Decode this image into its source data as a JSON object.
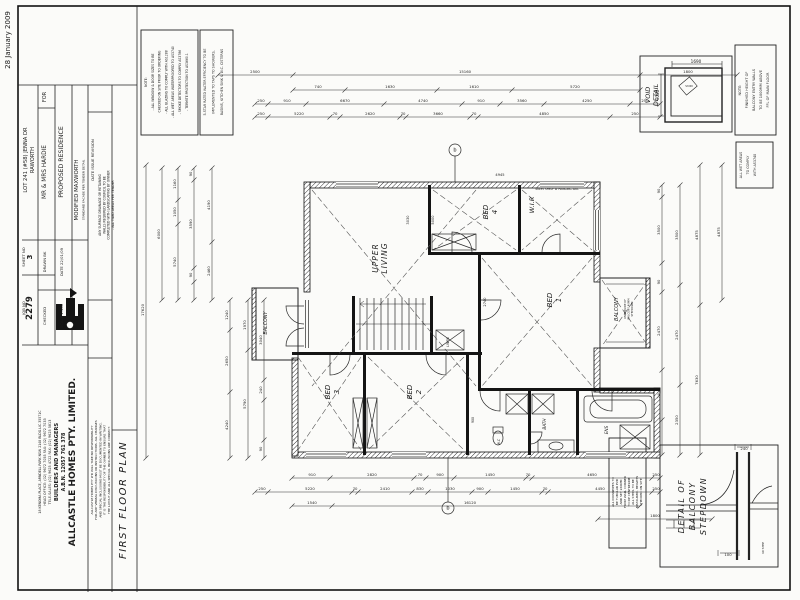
{
  "title_block": {
    "plan_title": "FIRST FLOOR PLAN",
    "side_date": "28 January 2009",
    "client_for": "FOR",
    "client": "MR & MRS HARDIE",
    "project": "PROPOSED RESIDENCE",
    "lot_line1": "LOT 241 (#58) JENNA DR",
    "lot_line2": "RAWORTH",
    "model": "MODIFIED MAXWORTH",
    "model_sub": "STANDARD FACADE PER TENDER DETAIL",
    "date": "DATE 22/01/09",
    "scale": "SCALE 1:100",
    "drawn": "DRAWN BK",
    "checked": "CHECKED",
    "sheet_label": "SHEET NO",
    "sheet_no": "3",
    "job_label": "JOB NO",
    "job_no": "2279",
    "revision_header": "DATE        ISSUE        REVISION",
    "company": {
      "name": "ALLCASTLE HOMES PTY. LIMITED.",
      "abn": "A.B.N. 12057 761 378",
      "role": "BUILDERS AND MANAGERS",
      "tel": "TELE-SALES: (02) 9625 4722   FAX: (02) 9625 5813",
      "head": "HEAD OFFICE: (02) 9672 7055   FAX: (02) 9672 7033",
      "address": "18 KENOMA PLACE, ARNDELL PARK NSW 2148    BLDG.LIC.35571C"
    }
  },
  "texts": [
    {
      "n": "side-date",
      "t": "28 January 2009",
      "x": 10,
      "y": 40,
      "rot": 1,
      "s": 7
    },
    {
      "n": "lot-block",
      "lines": [
        "LOT 241 (#58) JENNA DR",
        "RAWORTH"
      ],
      "x": 27,
      "y": 160,
      "rot": 1,
      "s": 5.2,
      "lh": 7
    },
    {
      "n": "sheet-label",
      "t": "SHEET NO",
      "x": 25,
      "y": 257,
      "rot": 1,
      "s": 3.8
    },
    {
      "n": "sheet-no",
      "t": "3",
      "x": 32,
      "y": 257,
      "rot": 1,
      "s": 7,
      "b": 1
    },
    {
      "n": "job-label",
      "t": "JOB NO",
      "x": 25,
      "y": 308,
      "rot": 1,
      "s": 3.8
    },
    {
      "n": "job-no",
      "t": "2279",
      "x": 32,
      "y": 308,
      "rot": 1,
      "s": 8.5,
      "b": 1
    },
    {
      "n": "for-label",
      "t": "FOR",
      "x": 46,
      "y": 97,
      "rot": 1,
      "s": 5
    },
    {
      "n": "client",
      "t": "MR & MRS HARDIE",
      "x": 46,
      "y": 172,
      "rot": 1,
      "s": 5.8
    },
    {
      "n": "drawn",
      "t": "DRAWN BK",
      "x": 46,
      "y": 262,
      "rot": 1,
      "s": 3.8
    },
    {
      "n": "checked",
      "t": "CHECKED",
      "x": 46,
      "y": 316,
      "rot": 1,
      "s": 3.8
    },
    {
      "n": "project",
      "t": "PROPOSED RESIDENCE",
      "x": 63,
      "y": 162,
      "rot": 1,
      "s": 6.2
    },
    {
      "n": "date",
      "t": "DATE 22/01/09",
      "x": 63,
      "y": 262,
      "rot": 1,
      "s": 3.8
    },
    {
      "n": "scale",
      "t": "SCALE 1:100",
      "x": 63,
      "y": 316,
      "rot": 1,
      "s": 3.8
    },
    {
      "n": "model",
      "t": "MODIFIED MAXWORTH",
      "x": 78,
      "y": 190,
      "rot": 1,
      "s": 5.4
    },
    {
      "n": "model-sub",
      "t": "STANDARD FACADE PER TENDER DETAIL",
      "x": 84.5,
      "y": 190,
      "rot": 1,
      "s": 3
    },
    {
      "n": "revision-header",
      "t": "DATE        ISSUE        REVISION",
      "x": 94,
      "y": 160,
      "rot": 1,
      "s": 3.8
    },
    {
      "n": "drainage-note",
      "lines": [
        "ANY SURFACE DRAINAGE OR RETAINING",
        "WALLS REQUIRED BY COUNCIL TO BE",
        "COMPLETED WITH LANDSCAPING BY OWNER",
        "- ALL TILED AREAS PER TENDER"
      ],
      "x": 101,
      "y": 205,
      "rot": 1,
      "s": 3.1,
      "lh": 4.3
    },
    {
      "n": "company-name",
      "t": "ALLCASTLE HOMES PTY. LIMITED.",
      "x": 75,
      "y": 462,
      "rot": 1,
      "s": 9,
      "b": 1
    },
    {
      "n": "company-abn",
      "t": "A.B.N. 12057 761 378",
      "x": 65,
      "y": 462,
      "rot": 1,
      "s": 4.8,
      "b": 1
    },
    {
      "n": "company-role",
      "t": "BUILDERS AND MANAGERS",
      "x": 58,
      "y": 462,
      "rot": 1,
      "s": 5.2,
      "b": 1
    },
    {
      "n": "company-tel",
      "t": "TELE-SALES: (02) 9625 4722   FAX: (02) 9625 5813",
      "x": 51,
      "y": 462,
      "rot": 1,
      "s": 3.4
    },
    {
      "n": "company-head",
      "t": "HEAD OFFICE: (02) 9672 7055   FAX: (02) 9672 7033",
      "x": 46,
      "y": 462,
      "rot": 1,
      "s": 3.4
    },
    {
      "n": "company-address",
      "t": "18 KENOMA PLACE, ARNDELL PARK NSW 2148    BLDG.LIC.35571C",
      "x": 41,
      "y": 462,
      "rot": 1,
      "s": 3.2
    },
    {
      "n": "disclaimer",
      "lines": [
        "ALLCASTLE HOMES PTY LTD WILL TAKE NO RESPONSIBILITY",
        "FOR ANY VERBAL DISCUSSIONS OR INSTRUCTIONS. ALL CHANGES",
        "AND SPECIAL INCLUSIONS MUST BE DOCUMENTED IN WRITING.",
        "IT IS THE RESPONSIBILITY OF THE OWNER TO ENSURE THAT",
        "THE LAYOUT AND ALL SPECIAL INCLUSIONS ARE CORRECT."
      ],
      "x": 93,
      "y": 470,
      "rot": 1,
      "s": 3,
      "lh": 4.2
    },
    {
      "n": "plan-title",
      "t": "FIRST FLOOR PLAN",
      "x": 126,
      "y": 500,
      "rot": 1,
      "s": 10,
      "i": 1,
      "ls": 1.5
    },
    {
      "n": "general-notes",
      "lines": [
        "NOTE:",
        "- ALL WINDOW & DOOR SIZES TO BE",
        "  CHECKED ON SITE PRIOR TO ORDERING",
        "- ALL GLAZING TO COMPLY WITH AS1288",
        "- ALL WET AREAS WATERPROOFED TO AS3740",
        "- SMOKE DETECTORS TO COMPLY AS3786",
        "- TERMITE PROTECTION TO AS3660.1"
      ],
      "x": 147,
      "y": 82,
      "rot": 1,
      "s": 3.1,
      "lh": 6.8
    },
    {
      "n": "five-star-note",
      "lines": [
        "5-STAR RATED WATER EFFICIENCY TO BE",
        "IMPLEMENTED TO TAPS TO SHOWERS,",
        "BASINS, KITCHEN SINK & W.C. CISTERNS"
      ],
      "x": 206,
      "y": 82,
      "rot": 1,
      "s": 3.3,
      "lh": 8.5
    },
    {
      "n": "void-detail-label",
      "lines": [
        "VOID",
        "DETAIL"
      ],
      "x": 650,
      "y": 95,
      "rot": 1,
      "s": 6.5,
      "i": 1,
      "lh": 8
    },
    {
      "n": "void-dim-top",
      "t": "1690",
      "x": 696,
      "y": 63,
      "s": 4.2
    },
    {
      "n": "void-dim-side",
      "t": "1000",
      "x": 659,
      "y": 95,
      "rot": 1,
      "s": 4.2
    },
    {
      "n": "void-tag",
      "t": "VOID",
      "x": 689,
      "y": 87,
      "s": 3
    },
    {
      "n": "balcony-wall-note",
      "lines": [
        "NOTE:",
        "FINISHED HEIGHT OF",
        "BALCONY ENTRY WALLS",
        "TO BE 1000MM ABOVE",
        "FFL OF MAIN FLOOR"
      ],
      "x": 741,
      "y": 90,
      "rot": 1,
      "s": 3.5,
      "lh": 7
    },
    {
      "n": "wet-area-note",
      "lines": [
        "ALL WET AREAS",
        "TO COMPLY",
        "WITH AS3740"
      ],
      "x": 742,
      "y": 165,
      "rot": 1,
      "s": 3.3,
      "lh": 7
    },
    {
      "n": "downpipe-steel-note",
      "lines": [
        "ALL DOWNPIPES TO",
        "BE TUBULAR PVD",
        "AND SET 240MM",
        "FROM WALL CORNER",
        "TO DP CENTRELINE",
        "ALL STEEL TO BE",
        "MEASURED, HEIGHTS",
        "CHECKED ON SITE"
      ],
      "x": 614,
      "y": 492,
      "rot": 1,
      "s": 3,
      "lh": 4
    },
    {
      "n": "stepdown-detail-label",
      "lines": [
        "DETAIL  OF",
        "BALCONY",
        "STEPDOWN"
      ],
      "x": 684,
      "y": 506,
      "rot": 1,
      "s": 8,
      "i": 1,
      "lh": 11,
      "ls": 1.5
    },
    {
      "n": "stepdown-dim-240",
      "t": "240",
      "x": 744,
      "y": 450,
      "s": 3.8
    },
    {
      "n": "stepdown-dim-100",
      "t": "100",
      "x": 728,
      "y": 556,
      "s": 3.8
    },
    {
      "n": "stepdown-dim-step",
      "t": "40 STEP",
      "x": 764,
      "y": 548,
      "rot": 1,
      "s": 3
    },
    {
      "n": "room-upper-living",
      "lines": [
        "UPPER",
        "LIVING"
      ],
      "x": 378,
      "y": 258,
      "rot": 1,
      "s": 7.5,
      "i": 1,
      "lh": 9,
      "ls": 1
    },
    {
      "n": "room-bed4",
      "lines": [
        "BED",
        "4"
      ],
      "x": 488,
      "y": 212,
      "rot": 1,
      "s": 7,
      "i": 1,
      "lh": 9
    },
    {
      "n": "room-wir",
      "t": "W.I.R",
      "x": 534,
      "y": 205,
      "rot": 1,
      "s": 6.5,
      "i": 1
    },
    {
      "n": "room-bed1",
      "lines": [
        "BED",
        "1"
      ],
      "x": 552,
      "y": 300,
      "rot": 1,
      "s": 7,
      "i": 1,
      "lh": 9
    },
    {
      "n": "room-balcony-right",
      "t": "BALCONY",
      "x": 618,
      "y": 309,
      "rot": 1,
      "s": 5,
      "i": 1
    },
    {
      "n": "balcony-right-note",
      "lines": [
        "UNDERSIDE OF",
        "BALCONY 40MM",
        "STEPDOWN"
      ],
      "x": 626,
      "y": 309,
      "rot": 1,
      "s": 2.6,
      "lh": 3.4
    },
    {
      "n": "room-bed3",
      "lines": [
        "BED",
        "3"
      ],
      "x": 330,
      "y": 392,
      "rot": 1,
      "s": 7,
      "i": 1,
      "lh": 9
    },
    {
      "n": "room-bed2",
      "lines": [
        "BED",
        "2"
      ],
      "x": 412,
      "y": 392,
      "rot": 1,
      "s": 7,
      "i": 1,
      "lh": 9
    },
    {
      "n": "room-bath",
      "t": "BATH",
      "x": 546,
      "y": 424,
      "rot": 1,
      "s": 4.2,
      "i": 1
    },
    {
      "n": "room-ens",
      "t": "ENS",
      "x": 608,
      "y": 430,
      "rot": 1,
      "s": 4.2,
      "i": 1
    },
    {
      "n": "room-wc",
      "t": "W.C",
      "x": 500,
      "y": 442,
      "rot": 1,
      "s": 3.2,
      "i": 1
    },
    {
      "n": "room-linen",
      "t": "LINEN",
      "x": 449,
      "y": 342,
      "rot": 1,
      "s": 3.2,
      "i": 1
    },
    {
      "n": "room-balcony-left",
      "t": "BALCONY",
      "x": 267,
      "y": 323,
      "rot": 1,
      "s": 4.8,
      "i": 1
    },
    {
      "n": "shelf-note",
      "t": "40x35 SHELF W HANGING RAIL",
      "x": 557,
      "y": 190,
      "s": 2.8
    },
    {
      "n": "marker-top",
      "t": "b",
      "x": 455,
      "y": 151.5,
      "s": 5
    },
    {
      "n": "marker-bottom",
      "t": "b",
      "x": 448,
      "y": 509.5,
      "s": 5
    },
    {
      "n": "inner-dim-5000",
      "t": "5000",
      "x": 434,
      "y": 220,
      "rot": 1,
      "s": 3.6
    },
    {
      "n": "inner-dim-3030",
      "t": "3030",
      "x": 409,
      "y": 220,
      "rot": 1,
      "s": 3.6
    },
    {
      "n": "inner-dim-2740",
      "t": "2740",
      "x": 486,
      "y": 302,
      "rot": 1,
      "s": 3.6
    },
    {
      "n": "inner-dim-4945",
      "t": "4945",
      "x": 500,
      "y": 176,
      "s": 3.6
    },
    {
      "n": "inner-dim-900",
      "t": "900",
      "x": 474,
      "y": 420,
      "rot": 1,
      "s": 3.2
    }
  ],
  "dim_chains": [
    {
      "o": "h",
      "pos": 75,
      "a": 218,
      "b": 737,
      "ticks": [
        218,
        293,
        640,
        737
      ],
      "labels": [
        {
          "t": "2500",
          "at": 255
        },
        {
          "t": "15160",
          "at": 465
        },
        {
          "t": "1800",
          "at": 688
        }
      ]
    },
    {
      "o": "h",
      "pos": 90,
      "a": 293,
      "b": 640,
      "ticks": [
        293,
        345,
        437,
        512,
        640
      ],
      "labels": [
        {
          "t": "740",
          "at": 318
        },
        {
          "t": "1630",
          "at": 390
        },
        {
          "t": "1610",
          "at": 474
        },
        {
          "t": "5720",
          "at": 575
        }
      ]
    },
    {
      "o": "h",
      "pos": 104,
      "a": 255,
      "b": 660,
      "ticks": [
        255,
        268,
        306,
        384,
        462,
        500,
        544,
        630,
        660
      ],
      "labels": [
        {
          "t": "250",
          "at": 261
        },
        {
          "t": "910",
          "at": 287
        },
        {
          "t": "6670",
          "at": 345
        },
        {
          "t": "4740",
          "at": 423
        },
        {
          "t": "910",
          "at": 481
        },
        {
          "t": "3560",
          "at": 522
        },
        {
          "t": "4250",
          "at": 587
        },
        {
          "t": "250",
          "at": 645
        }
      ]
    },
    {
      "o": "h",
      "pos": 117,
      "a": 255,
      "b": 660,
      "ticks": [
        255,
        268,
        330,
        340,
        400,
        406,
        470,
        478,
        610,
        660
      ],
      "labels": [
        {
          "t": "250",
          "at": 261
        },
        {
          "t": "5220",
          "at": 299
        },
        {
          "t": "70",
          "at": 335
        },
        {
          "t": "2620",
          "at": 370
        },
        {
          "t": "70",
          "at": 403
        },
        {
          "t": "3660",
          "at": 438
        },
        {
          "t": "70",
          "at": 474
        },
        {
          "t": "4850",
          "at": 544
        },
        {
          "t": "250",
          "at": 635
        }
      ]
    },
    {
      "o": "h",
      "pos": 478,
      "a": 292,
      "b": 660,
      "ticks": [
        292,
        330,
        414,
        426,
        454,
        526,
        532,
        652,
        660
      ],
      "labels": [
        {
          "t": "910",
          "at": 312
        },
        {
          "t": "2820",
          "at": 372
        },
        {
          "t": "70",
          "at": 420
        },
        {
          "t": "900",
          "at": 440
        },
        {
          "t": "1450",
          "at": 490
        },
        {
          "t": "70",
          "at": 528
        },
        {
          "t": "4650",
          "at": 592
        },
        {
          "t": "250",
          "at": 656
        }
      ]
    },
    {
      "o": "h",
      "pos": 492,
      "a": 255,
      "b": 660,
      "ticks": [
        255,
        268,
        352,
        358,
        412,
        428,
        472,
        488,
        542,
        548,
        652,
        660
      ],
      "labels": [
        {
          "t": "250",
          "at": 262
        },
        {
          "t": "5220",
          "at": 310
        },
        {
          "t": "70",
          "at": 355
        },
        {
          "t": "2410",
          "at": 385
        },
        {
          "t": "830",
          "at": 420
        },
        {
          "t": "1030",
          "at": 450
        },
        {
          "t": "900",
          "at": 480
        },
        {
          "t": "1450",
          "at": 515
        },
        {
          "t": "70",
          "at": 545
        },
        {
          "t": "4450",
          "at": 600
        },
        {
          "t": "250",
          "at": 656
        }
      ]
    },
    {
      "o": "h",
      "pos": 506,
      "a": 292,
      "b": 640,
      "ticks": [
        292,
        332,
        640
      ],
      "labels": [
        {
          "t": "1540",
          "at": 312
        },
        {
          "t": "16120",
          "at": 470
        }
      ]
    },
    {
      "o": "h",
      "pos": 519,
      "a": 598,
      "b": 712,
      "ticks": [
        598,
        712
      ],
      "labels": [
        {
          "t": "1800",
          "at": 655
        }
      ]
    },
    {
      "o": "v",
      "pos": 146,
      "a": 165,
      "b": 458,
      "ticks": [
        165,
        458
      ],
      "labels": [
        {
          "t": "17620",
          "at": 310
        }
      ]
    },
    {
      "o": "v",
      "pos": 162,
      "a": 168,
      "b": 300,
      "ticks": [
        168,
        300
      ],
      "labels": [
        {
          "t": "6000",
          "at": 234
        }
      ]
    },
    {
      "o": "v",
      "pos": 178,
      "a": 168,
      "b": 300,
      "ticks": [
        168,
        200,
        224,
        300
      ],
      "labels": [
        {
          "t": "1160",
          "at": 184
        },
        {
          "t": "1050",
          "at": 212
        },
        {
          "t": "5740",
          "at": 262
        }
      ]
    },
    {
      "o": "v",
      "pos": 194,
      "a": 168,
      "b": 300,
      "ticks": [
        168,
        180,
        268,
        282,
        300
      ],
      "labels": [
        {
          "t": "90",
          "at": 174
        },
        {
          "t": "3590",
          "at": 224
        },
        {
          "t": "90",
          "at": 275
        }
      ]
    },
    {
      "o": "v",
      "pos": 212,
      "a": 168,
      "b": 300,
      "ticks": [
        168,
        242,
        300
      ],
      "labels": [
        {
          "t": "4190",
          "at": 205
        },
        {
          "t": "2460",
          "at": 271
        }
      ]
    },
    {
      "o": "v",
      "pos": 230,
      "a": 300,
      "b": 458,
      "ticks": [
        300,
        330,
        392,
        458
      ],
      "labels": [
        {
          "t": "1240",
          "at": 315
        },
        {
          "t": "2650",
          "at": 361
        },
        {
          "t": "4240",
          "at": 425
        }
      ]
    },
    {
      "o": "v",
      "pos": 248,
      "a": 300,
      "b": 458,
      "ticks": [
        300,
        350,
        458
      ],
      "labels": [
        {
          "t": "1970",
          "at": 325
        },
        {
          "t": "5790",
          "at": 404
        }
      ]
    },
    {
      "o": "v",
      "pos": 264,
      "a": 300,
      "b": 458,
      "ticks": [
        300,
        380,
        400,
        440,
        458
      ],
      "labels": [
        {
          "t": "3040",
          "at": 340
        },
        {
          "t": "240",
          "at": 390
        },
        {
          "t": "90",
          "at": 449
        }
      ]
    },
    {
      "o": "v",
      "pos": 662,
      "a": 185,
      "b": 455,
      "ticks": [
        185,
        197,
        263,
        292,
        370,
        420,
        455
      ],
      "labels": [
        {
          "t": "90",
          "at": 191
        },
        {
          "t": "3500",
          "at": 230
        },
        {
          "t": "90",
          "at": 282
        },
        {
          "t": "2470",
          "at": 331
        },
        {
          "t": "240",
          "at": 395
        }
      ]
    },
    {
      "o": "v",
      "pos": 680,
      "a": 185,
      "b": 455,
      "ticks": [
        185,
        285,
        385,
        455
      ],
      "labels": [
        {
          "t": "3500",
          "at": 235
        },
        {
          "t": "2470",
          "at": 335
        },
        {
          "t": "2350",
          "at": 420
        }
      ]
    },
    {
      "o": "v",
      "pos": 700,
      "a": 165,
      "b": 455,
      "ticks": [
        165,
        305,
        455
      ],
      "labels": [
        {
          "t": "4875",
          "at": 235
        },
        {
          "t": "7630",
          "at": 380
        }
      ]
    },
    {
      "o": "v",
      "pos": 722,
      "a": 165,
      "b": 300,
      "ticks": [
        165,
        300
      ],
      "labels": [
        {
          "t": "4875",
          "at": 232
        }
      ]
    }
  ]
}
